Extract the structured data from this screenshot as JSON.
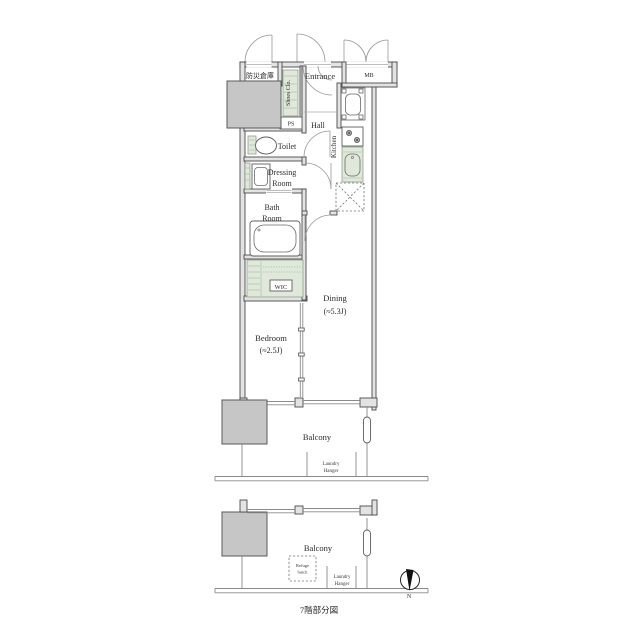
{
  "plan": {
    "labels": {
      "bousai": "防災倉庫",
      "entrance": "Entrance",
      "mb": "MB",
      "shoes": "Shoes Clo.",
      "ps": "PS",
      "hall": "Hall",
      "toilet": "Toilet",
      "kitchen": "Kitchen",
      "dressing_line1": "Dressing",
      "dressing_line2": "Room",
      "bath_line1": "Bath",
      "bath_line2": "Room",
      "wic": "WIC",
      "dining": "Dining",
      "dining_size": "(≈5.3J)",
      "bedroom": "Bedroom",
      "bedroom_size": "(≈2.5J)",
      "balcony_upper": "Balcony",
      "laundry_upper_line1": "Laundry",
      "laundry_upper_line2": "Hanger"
    },
    "lower_section": {
      "balcony": "Balcony",
      "refuge_line1": "Refuge",
      "refuge_line2": "hatch",
      "laundry_line1": "Laundry",
      "laundry_line2": "Hanger",
      "caption": "7階部分図"
    },
    "compass": {
      "north": "N"
    },
    "colors": {
      "wall_line": "#4a4a4a",
      "wall_fill": "#e3e3e3",
      "pillar_gray": "#c6c6c6",
      "fixture_green": "#dfe8da",
      "line_gray": "#8a8a8a"
    }
  }
}
